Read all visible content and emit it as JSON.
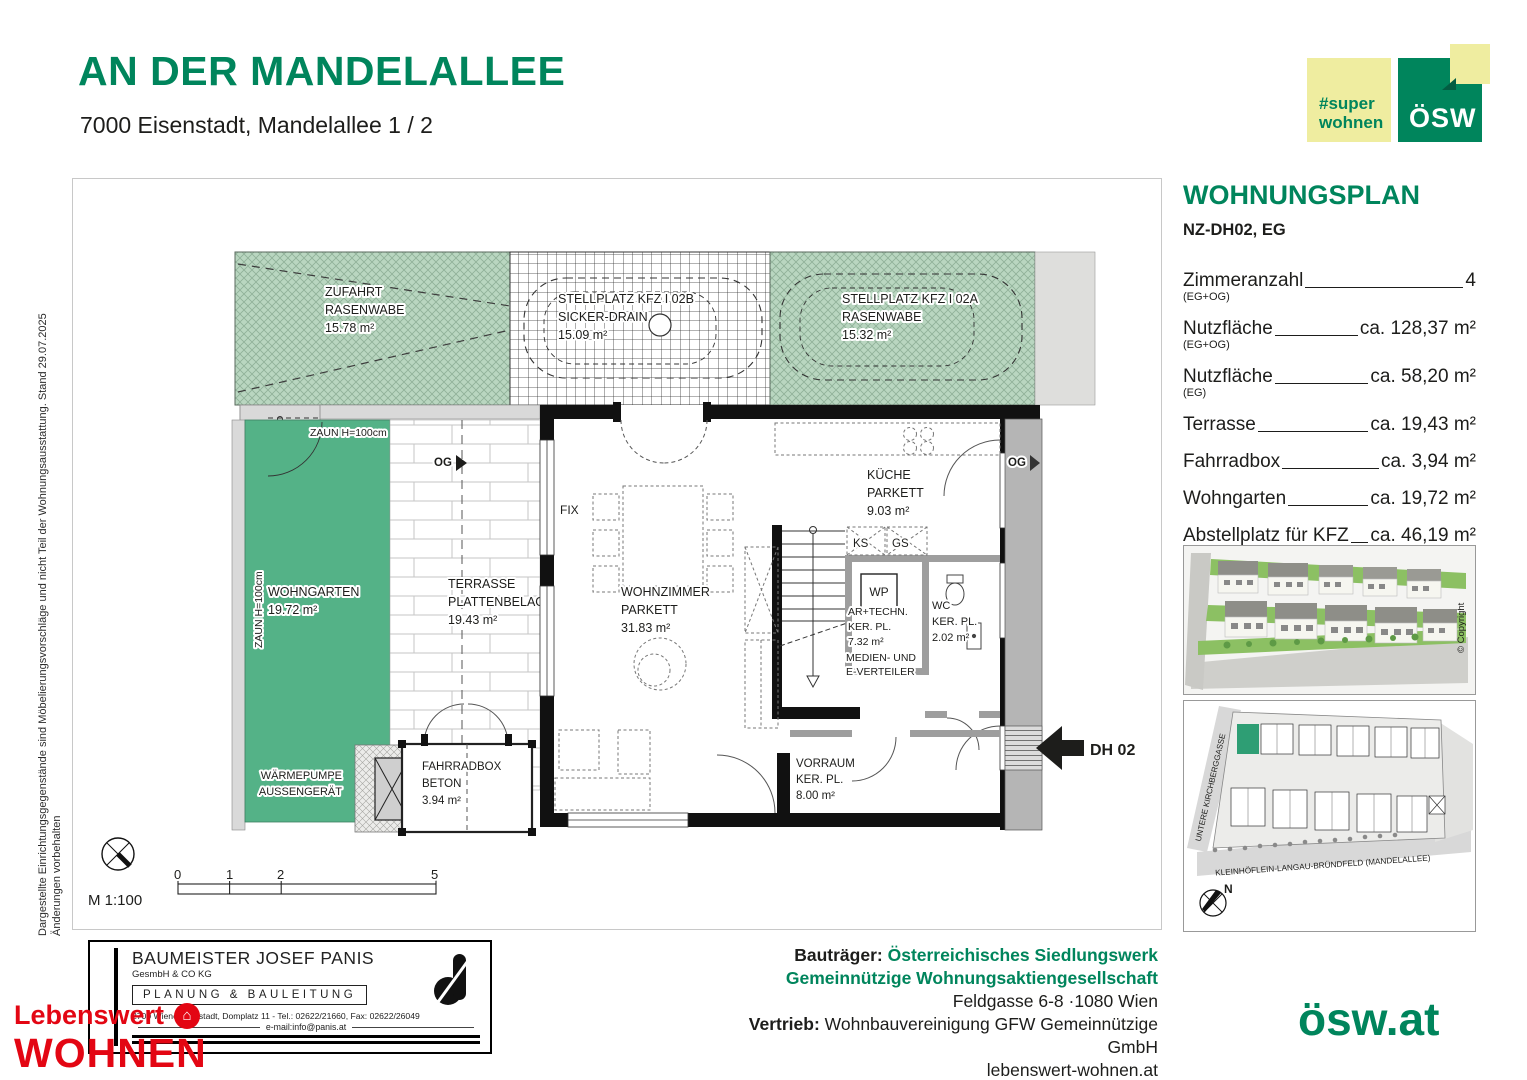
{
  "colors": {
    "brand_green": "#00855C",
    "pale_yellow": "#EFEDA0",
    "garden_green": "#54B287",
    "hatch_green": "#B9D6C0",
    "red": "#E30613",
    "strip_gray": "#B5B5B5"
  },
  "header": {
    "title": "AN DER MANDELALLEE",
    "subtitle": "7000 Eisenstadt, Mandelallee 1 / 2"
  },
  "logos": {
    "super_line1": "#super",
    "super_line2": "wohnen",
    "osw": "ÖSW",
    "house_glyph": "⌂"
  },
  "side_note": {
    "line1": "Dargestellte Einrichtungsgegenstände sind Möbelierungsvorschläge und nicht Teil der Wohnungsausstattung. Stand 29.07.2025",
    "line2": "Änderungen vorbehalten"
  },
  "panel": {
    "title": "WOHNUNGSPLAN",
    "unit": "NZ-DH02, EG",
    "specs": [
      {
        "label": "Zimmeranzahl",
        "sub": "(EG+OG)",
        "value": "4"
      },
      {
        "label": "Nutzfläche",
        "sub": "(EG+OG)",
        "value": "ca. 128,37 m²"
      },
      {
        "label": "Nutzfläche",
        "sub": "(EG)",
        "value": "ca. 58,20 m²"
      },
      {
        "label": "Terrasse",
        "sub": "",
        "value": "ca. 19,43 m²"
      },
      {
        "label": "Fahrradbox",
        "sub": "",
        "value": "ca. 3,94 m²"
      },
      {
        "label": "Wohngarten",
        "sub": "",
        "value": "ca. 19,72 m²"
      },
      {
        "label": "Abstellplatz für KFZ",
        "sub": "(Stellplatz A + B + Zufahrt)",
        "value": "ca. 46,19 m²"
      }
    ],
    "copyright": "© Copyright"
  },
  "siteplan": {
    "street_left": "UNTERE KIRCHBERGGASSE",
    "street_bottom": "KLEINHÖFLEIN-LANGAU-BRÜNDFELD (MANDELALLEE)",
    "north": "N"
  },
  "plan": {
    "zufahrt": [
      "ZUFAHRT",
      "RASENWABE",
      "15.78 m²"
    ],
    "stellplatz_b": [
      "STELLPLATZ KFZ I 02B",
      "SICKER-DRAIN",
      "15.09 m²"
    ],
    "stellplatz_a": [
      "STELLPLATZ KFZ I 02A",
      "RASENWABE",
      "15.32 m²"
    ],
    "zaun_top": "ZAUN H=100cm",
    "zaun_left": "ZAUN H=100cm",
    "wohngarten": [
      "WOHNGARTEN",
      "19.72 m²"
    ],
    "terrasse": [
      "TERRASSE",
      "PLATTENBELAG",
      "19.43 m²"
    ],
    "og": "OG",
    "fix": "FIX",
    "wohnzimmer": [
      "WOHNZIMMER",
      "PARKETT",
      "31.83 m²"
    ],
    "kueche": [
      "KÜCHE",
      "PARKETT",
      "9.03 m²"
    ],
    "ks": "KS",
    "gs": "GS",
    "wp": "WP",
    "technik": [
      "AR+TECHN.",
      "KER. PL.",
      "7.32 m²"
    ],
    "medien": [
      "MEDIEN- UND",
      "E-VERTEILER"
    ],
    "wc": [
      "WC",
      "KER. PL.",
      "2.02 m²"
    ],
    "vorraum": [
      "VORRAUM",
      "KER. PL.",
      "8.00 m²"
    ],
    "waermepumpe": [
      "WÄRMEPUMPE",
      "AUSSENGERÄT"
    ],
    "fahrradbox": [
      "FAHRRADBOX",
      "BETON",
      "3.94 m²"
    ],
    "dh": "DH 02",
    "scale": "M 1:100",
    "scale_ticks": [
      "0",
      "1",
      "2",
      "5"
    ]
  },
  "stamp": {
    "name": "BAUMEISTER JOSEF PANIS",
    "legal": "GesmbH & CO KG",
    "role": "PLANUNG & BAULEITUNG",
    "address": "2700 Wiener Neustadt, Domplatz 11 - Tel.: 02622/21660, Fax: 02622/26049",
    "email": "e-mail:info@panis.at"
  },
  "lebenswert": {
    "line1": "Lebenswert",
    "line2": "WOHNEN"
  },
  "footer": {
    "bautraeger_label": "Bauträger:",
    "bautraeger_1": "Österreichisches Siedlungswerk",
    "bautraeger_2": "Gemeinnützige Wohnungsaktiengesellschaft",
    "address": "Feldgasse 6-8 ·1080 Wien",
    "vertrieb_label": "Vertrieb:",
    "vertrieb": "Wohnbauvereinigung GFW Gemeinnützige GmbH",
    "website": "lebenswert-wohnen.at",
    "osw_url": "ösw.at"
  }
}
